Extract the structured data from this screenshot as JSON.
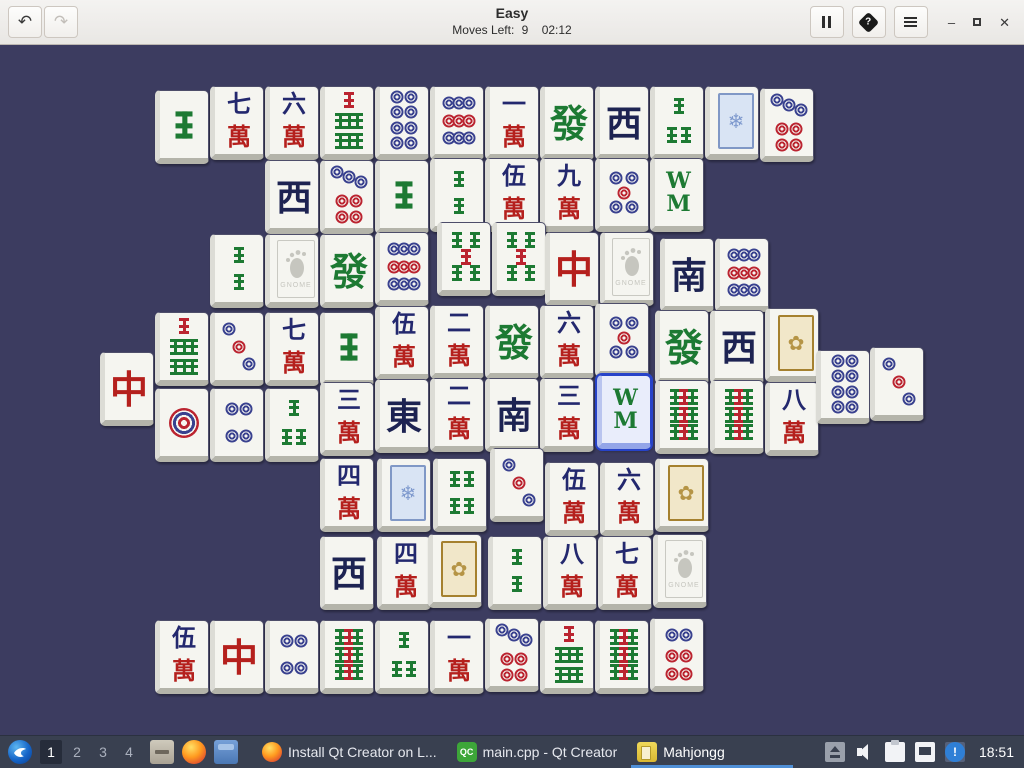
{
  "header": {
    "title": "Easy",
    "moves_label": "Moves Left:",
    "moves_value": "9",
    "timer": "02:12",
    "glyphs": {
      "undo": "↶",
      "redo": "↷",
      "help": "?",
      "minimize": "–",
      "close": "✕"
    }
  },
  "tiles_meta": {
    "wan_chars": {
      "1": "一",
      "2": "二",
      "3": "三",
      "4": "四",
      "5": "伍",
      "6": "六",
      "7": "七",
      "8": "八",
      "9": "九"
    },
    "wan_suffix": "萬",
    "winds": {
      "E": "東",
      "S": "南",
      "W": "西"
    },
    "dragons": {
      "R": "中",
      "G": "發"
    },
    "bamboo8_top": "W",
    "bamboo8_bottom": "M",
    "gnome_label": "GNOME",
    "flower_blue_glyph": "❄",
    "flower_gold_glyph": "✿",
    "colors": {
      "navy": "#23286e",
      "red": "#b5201d",
      "green": "#1d7a33",
      "dot_blue": "#39418f",
      "dot_red": "#bb2430",
      "wind": "#1d2352",
      "selected_border": "#2743c9",
      "board_bg": "#3c3c60"
    }
  },
  "board": {
    "tiles": [
      {
        "x": 155,
        "y": 45,
        "t": "b",
        "n": 1
      },
      {
        "x": 210,
        "y": 41,
        "t": "w",
        "n": 7
      },
      {
        "x": 265,
        "y": 41,
        "t": "w",
        "n": 6
      },
      {
        "x": 320,
        "y": 41,
        "t": "b",
        "n": 7
      },
      {
        "x": 375,
        "y": 41,
        "t": "c",
        "n": 8
      },
      {
        "x": 430,
        "y": 41,
        "t": "c",
        "n": 9
      },
      {
        "x": 485,
        "y": 41,
        "t": "w",
        "n": 1
      },
      {
        "x": 540,
        "y": 41,
        "t": "dragon",
        "v": "G"
      },
      {
        "x": 595,
        "y": 41,
        "t": "wind",
        "v": "W"
      },
      {
        "x": 650,
        "y": 41,
        "t": "b",
        "n": 3
      },
      {
        "x": 705,
        "y": 41,
        "t": "flower",
        "v": "blue"
      },
      {
        "x": 760,
        "y": 43,
        "t": "c",
        "n": 7
      },
      {
        "x": 265,
        "y": 115,
        "t": "wind",
        "v": "W"
      },
      {
        "x": 320,
        "y": 115,
        "t": "c",
        "n": 7
      },
      {
        "x": 375,
        "y": 115,
        "t": "b",
        "n": 1
      },
      {
        "x": 430,
        "y": 113,
        "t": "b",
        "n": 2
      },
      {
        "x": 485,
        "y": 113,
        "t": "w",
        "n": 5
      },
      {
        "x": 540,
        "y": 113,
        "t": "w",
        "n": 9
      },
      {
        "x": 595,
        "y": 113,
        "t": "c",
        "n": 5
      },
      {
        "x": 650,
        "y": 113,
        "t": "b",
        "n": 8
      },
      {
        "x": 210,
        "y": 189,
        "t": "b",
        "n": 2
      },
      {
        "x": 265,
        "y": 189,
        "t": "gnome"
      },
      {
        "x": 320,
        "y": 189,
        "t": "dragon",
        "v": "G"
      },
      {
        "x": 375,
        "y": 187,
        "t": "c",
        "n": 9
      },
      {
        "x": 437,
        "y": 177,
        "t": "b",
        "n": 5
      },
      {
        "x": 492,
        "y": 177,
        "t": "b",
        "n": 5
      },
      {
        "x": 545,
        "y": 187,
        "t": "dragon",
        "v": "R"
      },
      {
        "x": 600,
        "y": 187,
        "t": "gnome"
      },
      {
        "x": 660,
        "y": 193,
        "t": "wind",
        "v": "S"
      },
      {
        "x": 715,
        "y": 193,
        "t": "c",
        "n": 9
      },
      {
        "x": 100,
        "y": 307,
        "t": "dragon",
        "v": "R"
      },
      {
        "x": 155,
        "y": 267,
        "t": "b",
        "n": 7
      },
      {
        "x": 210,
        "y": 267,
        "t": "c",
        "n": 3
      },
      {
        "x": 265,
        "y": 267,
        "t": "w",
        "n": 7
      },
      {
        "x": 320,
        "y": 267,
        "t": "b",
        "n": 1
      },
      {
        "x": 375,
        "y": 261,
        "t": "w",
        "n": 5
      },
      {
        "x": 430,
        "y": 260,
        "t": "w",
        "n": 2
      },
      {
        "x": 485,
        "y": 260,
        "t": "dragon",
        "v": "G"
      },
      {
        "x": 540,
        "y": 260,
        "t": "w",
        "n": 6
      },
      {
        "x": 595,
        "y": 258,
        "t": "c",
        "n": 5
      },
      {
        "x": 655,
        "y": 265,
        "t": "dragon",
        "v": "G"
      },
      {
        "x": 710,
        "y": 265,
        "t": "wind",
        "v": "W"
      },
      {
        "x": 765,
        "y": 263,
        "t": "flower",
        "v": "gold"
      },
      {
        "x": 155,
        "y": 343,
        "t": "c",
        "n": 1
      },
      {
        "x": 210,
        "y": 343,
        "t": "c",
        "n": 4
      },
      {
        "x": 265,
        "y": 343,
        "t": "b",
        "n": 3
      },
      {
        "x": 320,
        "y": 337,
        "t": "w",
        "n": 3
      },
      {
        "x": 375,
        "y": 334,
        "t": "wind",
        "v": "E"
      },
      {
        "x": 430,
        "y": 333,
        "t": "w",
        "n": 2
      },
      {
        "x": 485,
        "y": 333,
        "t": "wind",
        "v": "S"
      },
      {
        "x": 540,
        "y": 333,
        "t": "w",
        "n": 3
      },
      {
        "x": 597,
        "y": 330,
        "t": "b",
        "n": 8,
        "sel": true
      },
      {
        "x": 655,
        "y": 335,
        "t": "b",
        "n": 9
      },
      {
        "x": 710,
        "y": 335,
        "t": "b",
        "n": 9
      },
      {
        "x": 765,
        "y": 337,
        "t": "w",
        "n": 8
      },
      {
        "x": 816,
        "y": 305,
        "t": "c",
        "n": 8
      },
      {
        "x": 870,
        "y": 302,
        "t": "c",
        "n": 3
      },
      {
        "x": 320,
        "y": 413,
        "t": "w",
        "n": 4
      },
      {
        "x": 377,
        "y": 413,
        "t": "flower",
        "v": "blue"
      },
      {
        "x": 433,
        "y": 413,
        "t": "b",
        "n": 4
      },
      {
        "x": 490,
        "y": 403,
        "t": "c",
        "n": 3
      },
      {
        "x": 545,
        "y": 417,
        "t": "w",
        "n": 5
      },
      {
        "x": 600,
        "y": 417,
        "t": "w",
        "n": 6
      },
      {
        "x": 655,
        "y": 413,
        "t": "flower",
        "v": "gold"
      },
      {
        "x": 320,
        "y": 491,
        "t": "wind",
        "v": "W"
      },
      {
        "x": 377,
        "y": 491,
        "t": "w",
        "n": 4
      },
      {
        "x": 428,
        "y": 489,
        "t": "flower",
        "v": "gold"
      },
      {
        "x": 488,
        "y": 491,
        "t": "b",
        "n": 2
      },
      {
        "x": 543,
        "y": 491,
        "t": "w",
        "n": 8
      },
      {
        "x": 598,
        "y": 491,
        "t": "w",
        "n": 7
      },
      {
        "x": 653,
        "y": 489,
        "t": "gnome"
      },
      {
        "x": 155,
        "y": 575,
        "t": "w",
        "n": 5
      },
      {
        "x": 210,
        "y": 575,
        "t": "dragon",
        "v": "R"
      },
      {
        "x": 265,
        "y": 575,
        "t": "c",
        "n": 4
      },
      {
        "x": 320,
        "y": 575,
        "t": "b",
        "n": 9
      },
      {
        "x": 375,
        "y": 575,
        "t": "b",
        "n": 3
      },
      {
        "x": 430,
        "y": 575,
        "t": "w",
        "n": 1
      },
      {
        "x": 485,
        "y": 573,
        "t": "c",
        "n": 7
      },
      {
        "x": 540,
        "y": 575,
        "t": "b",
        "n": 7
      },
      {
        "x": 595,
        "y": 575,
        "t": "b",
        "n": 9
      },
      {
        "x": 650,
        "y": 573,
        "t": "c",
        "n": 6
      }
    ]
  },
  "taskbar": {
    "workspaces": [
      "1",
      "2",
      "3",
      "4"
    ],
    "active_workspace": "1",
    "windows": [
      {
        "icon": "firefox",
        "label": "Install Qt Creator on L..."
      },
      {
        "icon": "qtcreator",
        "icon_text": "QC",
        "label": "main.cpp - Qt Creator"
      },
      {
        "icon": "mahjongg",
        "label": "Mahjongg",
        "active": true
      }
    ],
    "clock": "18:51"
  }
}
